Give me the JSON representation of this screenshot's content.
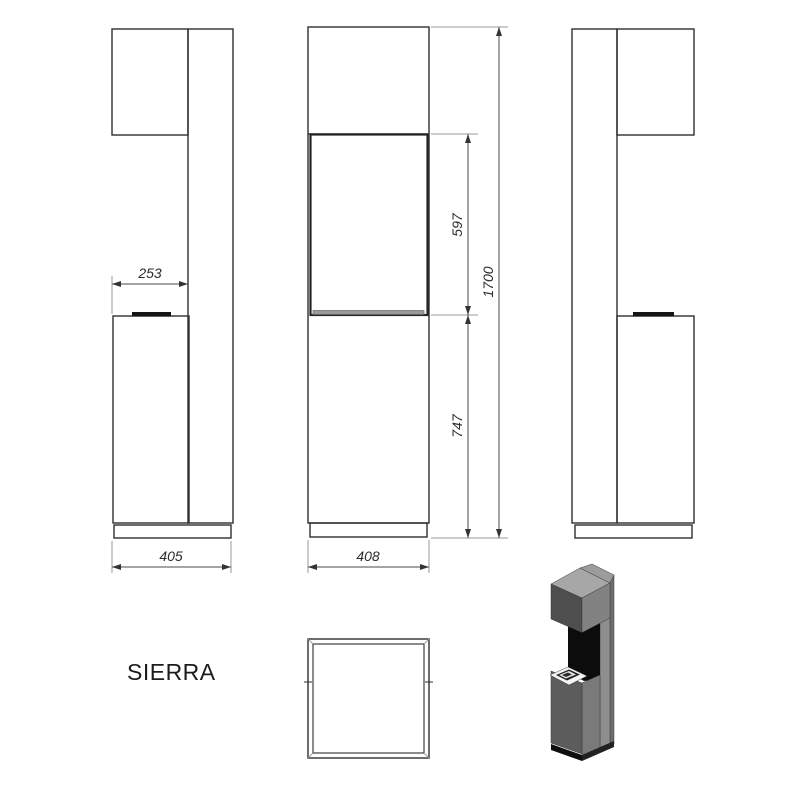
{
  "sheet": {
    "product_name": "SIERRA"
  },
  "dimensions": {
    "hood_depth_mm": "253",
    "total_depth_mm": "405",
    "firebox_height_mm": "597",
    "total_height_mm": "1700",
    "lower_section_height_mm": "747",
    "width_mm": "408"
  },
  "colors": {
    "background": "#ffffff",
    "outline": "#2f2f2f",
    "dimension_line": "#4a4a4a",
    "extension_line": "#9a9a9a",
    "burner_strip_black": "#151515",
    "shelf_gray": "#999999",
    "render_top_gray": "#a7a7a7",
    "render_front_gray": "#828282",
    "render_side_dark_gray": "#4e4e4e",
    "render_niche_black": "#0c0c0c",
    "render_tray_white": "#f4f4f4",
    "render_plinth_black": "#0f0f0f"
  }
}
